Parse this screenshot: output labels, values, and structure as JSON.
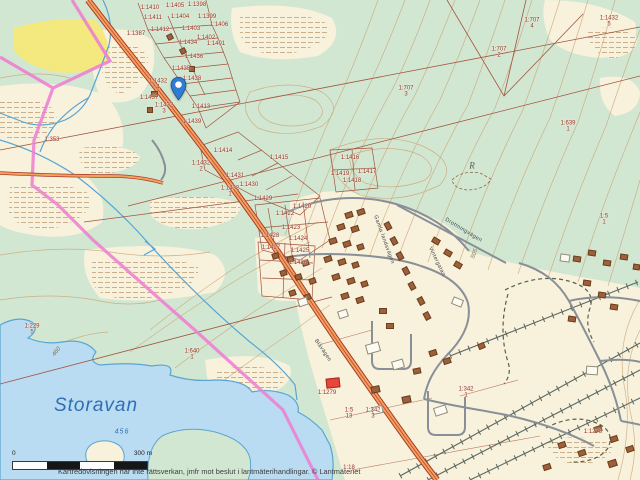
{
  "map": {
    "attribution": "Kartredovisningen har inte rättsverkan, jmfr mot beslut i lantmäterihandlingar. © Lantmäteriet",
    "scalebar": {
      "start": "0",
      "end": "300 m"
    },
    "pin": {
      "x": 170,
      "y": 76
    },
    "colors": {
      "forest_green": "#d2e7d2",
      "open_land": "#f8f1dc",
      "water": "#b9dcf2",
      "water_line": "#5aa5d0",
      "road_fill": "#f2a25e",
      "road_edge": "#a93b28",
      "parcel_line": "#a2543e",
      "parcel_text": "#9b3528",
      "boundary_pink": "#ee7fd2",
      "field_yellow": "#f3e97e",
      "street_gray": "#898f96",
      "house_brown": "#9c6138",
      "public_red": "#e8463a",
      "pin_blue": "#2e7cd6"
    },
    "water_labels": [
      {
        "text": "Storavan",
        "x": 96,
        "y": 406,
        "size": 19
      },
      {
        "text": "456",
        "x": 122,
        "y": 432,
        "size": 7
      }
    ],
    "contour_labels": [
      {
        "text": "460",
        "x": 57,
        "y": 352,
        "rot": -52
      },
      {
        "text": "505",
        "x": 475,
        "y": 254,
        "rot": -68
      }
    ],
    "monument_label": {
      "text": "R",
      "x": 472,
      "y": 166
    },
    "street_labels": [
      {
        "text": "Blåvägen",
        "x": 322,
        "y": 351,
        "rot": 56
      },
      {
        "text": "Gamla landsvägen",
        "x": 383,
        "y": 240,
        "rot": 70
      },
      {
        "text": "Drottningvägen",
        "x": 463,
        "y": 231,
        "rot": 31
      },
      {
        "text": "Vintergatan",
        "x": 436,
        "y": 262,
        "rot": 64
      }
    ],
    "parcel_labels": [
      {
        "text": "1:1410",
        "x": 150,
        "y": 8
      },
      {
        "text": "1:1405",
        "x": 175,
        "y": 6
      },
      {
        "text": "1:1398",
        "x": 197,
        "y": 5
      },
      {
        "text": "1:1411",
        "x": 153,
        "y": 18
      },
      {
        "text": "1:1404",
        "x": 180,
        "y": 17
      },
      {
        "text": "1:1399",
        "x": 207,
        "y": 17
      },
      {
        "text": "1:1387",
        "x": 136,
        "y": 34
      },
      {
        "text": "1:1412",
        "x": 160,
        "y": 30
      },
      {
        "text": "1:1403",
        "x": 191,
        "y": 29
      },
      {
        "text": "1:1406",
        "x": 219,
        "y": 25
      },
      {
        "text": "1:1434",
        "x": 188,
        "y": 43
      },
      {
        "text": "1:1402",
        "x": 206,
        "y": 38
      },
      {
        "text": "1:1401",
        "x": 216,
        "y": 44
      },
      {
        "text": "1:1436",
        "x": 194,
        "y": 57
      },
      {
        "text": "1:1435",
        "x": 181,
        "y": 69
      },
      {
        "text": "1:1438",
        "x": 192,
        "y": 79
      },
      {
        "text": "1:1432",
        "sub": "4",
        "x": 158,
        "y": 85
      },
      {
        "text": "1:1437",
        "x": 149,
        "y": 98
      },
      {
        "text": "1:1432",
        "sub": "3",
        "x": 164,
        "y": 109
      },
      {
        "text": "1:1413",
        "x": 201,
        "y": 107
      },
      {
        "text": "1:1439",
        "x": 192,
        "y": 122
      },
      {
        "text": "1:1414",
        "x": 223,
        "y": 151
      },
      {
        "text": "1:1415",
        "x": 279,
        "y": 158
      },
      {
        "text": "1:1416",
        "x": 350,
        "y": 158
      },
      {
        "text": "1:1419",
        "x": 340,
        "y": 174
      },
      {
        "text": "1:1417",
        "x": 367,
        "y": 172
      },
      {
        "text": "1:1418",
        "x": 352,
        "y": 181
      },
      {
        "text": "1:1432",
        "sub": "2",
        "x": 201,
        "y": 167
      },
      {
        "text": "1:1431",
        "x": 235,
        "y": 176
      },
      {
        "text": "1:1430",
        "x": 249,
        "y": 185
      },
      {
        "text": "1:1432",
        "sub": "1",
        "x": 230,
        "y": 192
      },
      {
        "text": "1:1429",
        "x": 263,
        "y": 199
      },
      {
        "text": "1:1420",
        "x": 302,
        "y": 207
      },
      {
        "text": "1:1422",
        "x": 285,
        "y": 214
      },
      {
        "text": "1:1423",
        "x": 291,
        "y": 228
      },
      {
        "text": "1:1428",
        "x": 270,
        "y": 236
      },
      {
        "text": "1:1424",
        "x": 298,
        "y": 239
      },
      {
        "text": "1:1427",
        "x": 271,
        "y": 248
      },
      {
        "text": "1:1425",
        "x": 300,
        "y": 251
      },
      {
        "text": "1:1426",
        "x": 298,
        "y": 263
      },
      {
        "text": "1:707",
        "sub": "4",
        "x": 532,
        "y": 24
      },
      {
        "text": "1:707",
        "sub": "2",
        "x": 499,
        "y": 53
      },
      {
        "text": "1:1432",
        "sub": "5",
        "x": 609,
        "y": 22
      },
      {
        "text": "1:707",
        "sub": "3",
        "x": 406,
        "y": 92
      },
      {
        "text": "1:639",
        "sub": "1",
        "x": 568,
        "y": 127
      },
      {
        "text": "1:5",
        "sub": "1",
        "x": 604,
        "y": 220
      },
      {
        "text": "1:353",
        "x": 52,
        "y": 140
      },
      {
        "text": "1:229",
        "sub": "5",
        "x": 32,
        "y": 330
      },
      {
        "text": "1:640",
        "sub": "1",
        "x": 192,
        "y": 355
      },
      {
        "text": "1:1279",
        "x": 327,
        "y": 393
      },
      {
        "text": "1:5",
        "sub": "13",
        "x": 349,
        "y": 414
      },
      {
        "text": "1:342",
        "sub": "3",
        "x": 373,
        "y": 414
      },
      {
        "text": "1:342",
        "sub": "1",
        "x": 466,
        "y": 393
      },
      {
        "text": "1:1278",
        "x": 593,
        "y": 432
      },
      {
        "text": "1:18",
        "x": 349,
        "y": 468
      }
    ],
    "buildings": {
      "houses": [
        [
          345,
          212,
          6,
          4,
          -18
        ],
        [
          357,
          209,
          6,
          4,
          -18
        ],
        [
          337,
          224,
          6,
          4,
          -18
        ],
        [
          351,
          226,
          6,
          4,
          -18
        ],
        [
          329,
          238,
          6,
          4,
          -18
        ],
        [
          343,
          241,
          6,
          4,
          -18
        ],
        [
          357,
          244,
          5,
          4,
          -18
        ],
        [
          324,
          256,
          6,
          4,
          -18
        ],
        [
          338,
          259,
          6,
          4,
          -18
        ],
        [
          352,
          262,
          5,
          4,
          -18
        ],
        [
          332,
          274,
          6,
          4,
          -18
        ],
        [
          347,
          278,
          6,
          4,
          -18
        ],
        [
          361,
          281,
          5,
          4,
          -18
        ],
        [
          341,
          293,
          6,
          4,
          -18
        ],
        [
          356,
          297,
          6,
          4,
          -18
        ],
        [
          384,
          223,
          6,
          4,
          62
        ],
        [
          390,
          238,
          6,
          4,
          62
        ],
        [
          396,
          253,
          6,
          4,
          62
        ],
        [
          402,
          268,
          6,
          4,
          62
        ],
        [
          408,
          283,
          6,
          4,
          62
        ],
        [
          417,
          298,
          6,
          4,
          62
        ],
        [
          423,
          313,
          6,
          4,
          62
        ],
        [
          432,
          238,
          6,
          4,
          30
        ],
        [
          444,
          250,
          6,
          4,
          30
        ],
        [
          454,
          262,
          6,
          4,
          30
        ],
        [
          379,
          308,
          6,
          4,
          0
        ],
        [
          386,
          323,
          6,
          4,
          0
        ],
        [
          429,
          350,
          6,
          4,
          -18
        ],
        [
          443,
          358,
          6,
          4,
          -18
        ],
        [
          371,
          386,
          7,
          5,
          -12
        ],
        [
          402,
          396,
          7,
          5,
          -12
        ],
        [
          573,
          256,
          6,
          4,
          8
        ],
        [
          588,
          250,
          6,
          4,
          8
        ],
        [
          603,
          260,
          6,
          4,
          8
        ],
        [
          620,
          254,
          6,
          4,
          8
        ],
        [
          633,
          264,
          5,
          4,
          8
        ],
        [
          583,
          280,
          6,
          4,
          8
        ],
        [
          598,
          292,
          6,
          4,
          8
        ],
        [
          610,
          304,
          6,
          4,
          8
        ],
        [
          568,
          316,
          6,
          4,
          8
        ],
        [
          594,
          426,
          6,
          4,
          -18
        ],
        [
          610,
          436,
          6,
          4,
          -18
        ],
        [
          626,
          446,
          6,
          4,
          -18
        ],
        [
          578,
          450,
          6,
          4,
          -18
        ],
        [
          558,
          442,
          6,
          4,
          -18
        ],
        [
          543,
          464,
          6,
          4,
          -18
        ],
        [
          608,
          460,
          7,
          5,
          -18
        ],
        [
          272,
          253,
          5,
          4,
          -18
        ],
        [
          287,
          256,
          5,
          4,
          -18
        ],
        [
          302,
          260,
          5,
          4,
          -18
        ],
        [
          280,
          270,
          5,
          4,
          -18
        ],
        [
          295,
          274,
          5,
          4,
          -18
        ],
        [
          309,
          278,
          5,
          4,
          -18
        ],
        [
          289,
          290,
          5,
          4,
          -18
        ],
        [
          304,
          294,
          5,
          4,
          -18
        ],
        [
          167,
          34,
          4,
          4,
          -28
        ],
        [
          180,
          48,
          4,
          4,
          -28
        ],
        [
          189,
          66,
          4,
          4,
          0
        ],
        [
          151,
          91,
          5,
          4,
          0
        ],
        [
          147,
          107,
          4,
          4,
          0
        ],
        [
          478,
          343,
          5,
          4,
          -24
        ],
        [
          413,
          368,
          6,
          4,
          -12
        ]
      ],
      "sheds": [
        [
          366,
          343,
          12,
          8,
          -16
        ],
        [
          392,
          360,
          10,
          7,
          -16
        ],
        [
          434,
          406,
          11,
          7,
          -18
        ],
        [
          298,
          298,
          8,
          6,
          -18
        ],
        [
          452,
          298,
          9,
          6,
          22
        ],
        [
          586,
          366,
          10,
          7,
          4
        ],
        [
          338,
          310,
          8,
          6,
          -18
        ],
        [
          372,
          406,
          9,
          6,
          -12
        ],
        [
          560,
          254,
          8,
          6,
          8
        ]
      ],
      "public": [
        [
          326,
          378,
          12,
          8,
          -6
        ]
      ]
    }
  }
}
